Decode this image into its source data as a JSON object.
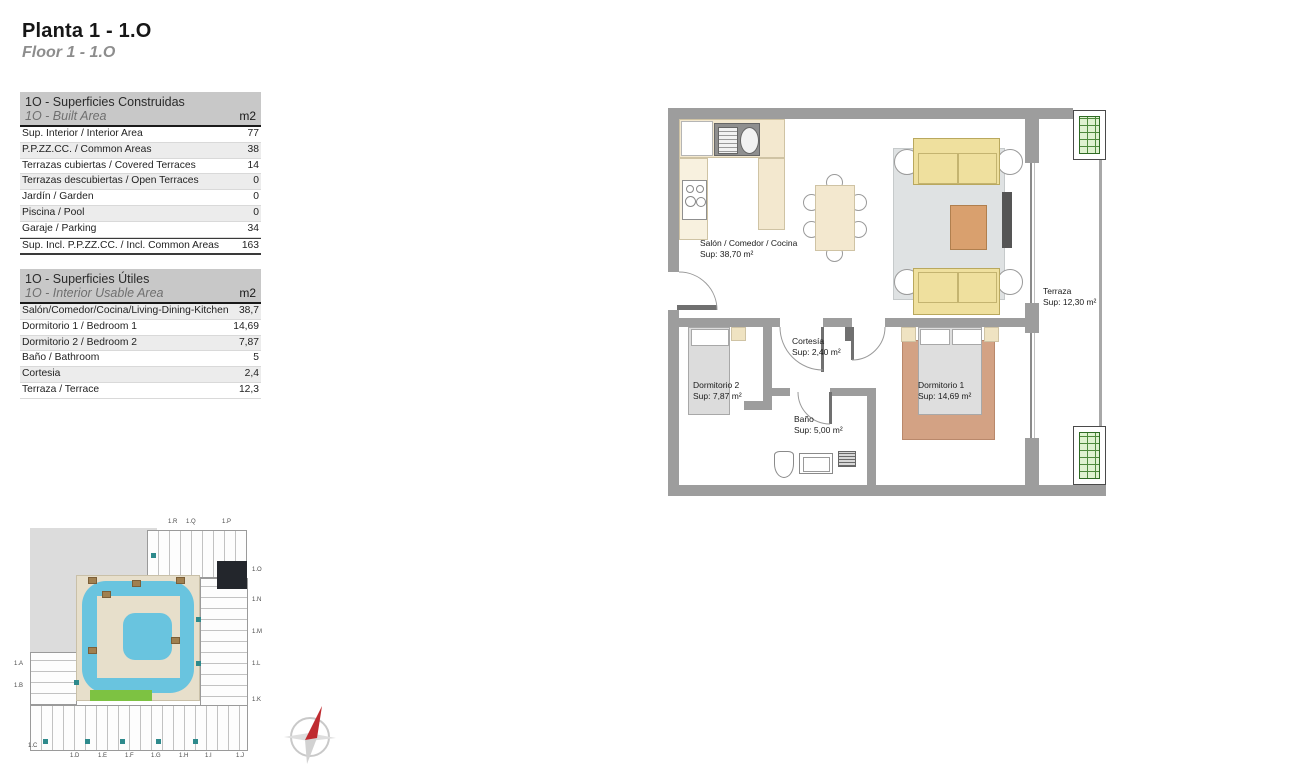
{
  "page": {
    "title": "Planta 1 - 1.O",
    "subtitle": "Floor 1 - 1.O"
  },
  "tables": [
    {
      "title": "1O - Superficies Construidas",
      "subtitle": "1O - Built Area",
      "unit": "m2",
      "shade": "even",
      "total_last_row": true,
      "rows": [
        [
          "Sup. Interior / Interior Area",
          "77"
        ],
        [
          "P.P.ZZ.CC. / Common Areas",
          "38"
        ],
        [
          "Terrazas cubiertas / Covered Terraces",
          "14"
        ],
        [
          "Terrazas descubiertas / Open Terraces",
          "0"
        ],
        [
          "Jardín / Garden",
          "0"
        ],
        [
          "Piscina / Pool",
          "0"
        ],
        [
          "Garaje / Parking",
          "34"
        ],
        [
          "Sup. Incl. P.P.ZZ.CC. / Incl. Common Areas",
          "163"
        ]
      ]
    },
    {
      "title": "1O - Superficies Útiles",
      "subtitle": "1O - Interior Usable Area",
      "unit": "m2",
      "shade": "odd",
      "total_last_row": false,
      "rows": [
        [
          "Salón/Comedor/Cocina/Living-Dining-Kitchen",
          "38,7"
        ],
        [
          "Dormitorio 1 / Bedroom 1",
          "14,69"
        ],
        [
          "Dormitorio 2 / Bedroom 2",
          "7,87"
        ],
        [
          "Baño  / Bathroom",
          "5"
        ],
        [
          "Cortesia",
          "2,4"
        ],
        [
          "Terraza / Terrace",
          "12,3"
        ]
      ]
    }
  ],
  "floorplan": {
    "rooms": [
      {
        "id": "salon",
        "name": "Salón / Comedor / Cocina",
        "sup": "Sup: 38,70 m²",
        "x": 32,
        "y": 130
      },
      {
        "id": "terraza",
        "name": "Terraza",
        "sup": "Sup: 12,30 m²",
        "x": 375,
        "y": 178
      },
      {
        "id": "cortesia",
        "name": "Cortesía",
        "sup": "Sup: 2,40 m²",
        "x": 124,
        "y": 228
      },
      {
        "id": "dormitorio2",
        "name": "Dormitorio 2",
        "sup": "Sup: 7,87 m²",
        "x": 25,
        "y": 272
      },
      {
        "id": "dormitorio1",
        "name": "Dormitorio 1",
        "sup": "Sup: 14,69 m²",
        "x": 250,
        "y": 272
      },
      {
        "id": "bano",
        "name": "Baño",
        "sup": "Sup: 5,00 m²",
        "x": 126,
        "y": 306
      }
    ]
  },
  "siteplan": {
    "highlighted_unit": "1.O",
    "unit_labels": [
      {
        "label": "1.R",
        "x": 140,
        "y": -6
      },
      {
        "label": "1.Q",
        "x": 158,
        "y": -6
      },
      {
        "label": "1.P",
        "x": 194,
        "y": -6
      },
      {
        "label": "1.O",
        "x": 224,
        "y": 42
      },
      {
        "label": "1.N",
        "x": 224,
        "y": 72
      },
      {
        "label": "1.M",
        "x": 224,
        "y": 104
      },
      {
        "label": "1.L",
        "x": 224,
        "y": 136
      },
      {
        "label": "1.K",
        "x": 224,
        "y": 172
      },
      {
        "label": "1.A",
        "x": -14,
        "y": 136
      },
      {
        "label": "1.B",
        "x": -14,
        "y": 158
      },
      {
        "label": "1.C",
        "x": 0,
        "y": 218
      },
      {
        "label": "1.D",
        "x": 42,
        "y": 228
      },
      {
        "label": "1.E",
        "x": 70,
        "y": 228
      },
      {
        "label": "1.F",
        "x": 97,
        "y": 228
      },
      {
        "label": "1.G",
        "x": 123,
        "y": 228
      },
      {
        "label": "1.H",
        "x": 151,
        "y": 228
      },
      {
        "label": "1.I",
        "x": 177,
        "y": 228
      },
      {
        "label": "1.J",
        "x": 208,
        "y": 228
      }
    ]
  },
  "colors": {
    "wall": "#9d9d9d",
    "furniture_beige": "#f3e8cf",
    "sofa_yellow": "#efe09e",
    "living_rug": "#dfe2e3",
    "coffee_table": "#d9a06e",
    "bedroom_rug": "#d3a284",
    "pool_blue": "#69c4df",
    "deck_beige": "#e7dfcb",
    "lawn_green": "#7dc242",
    "teal_accent": "#2e8a8c",
    "highlight_unit": "#23262c",
    "compass_red": "#bf2b30",
    "table_header_bg": "#c8c8c8"
  }
}
